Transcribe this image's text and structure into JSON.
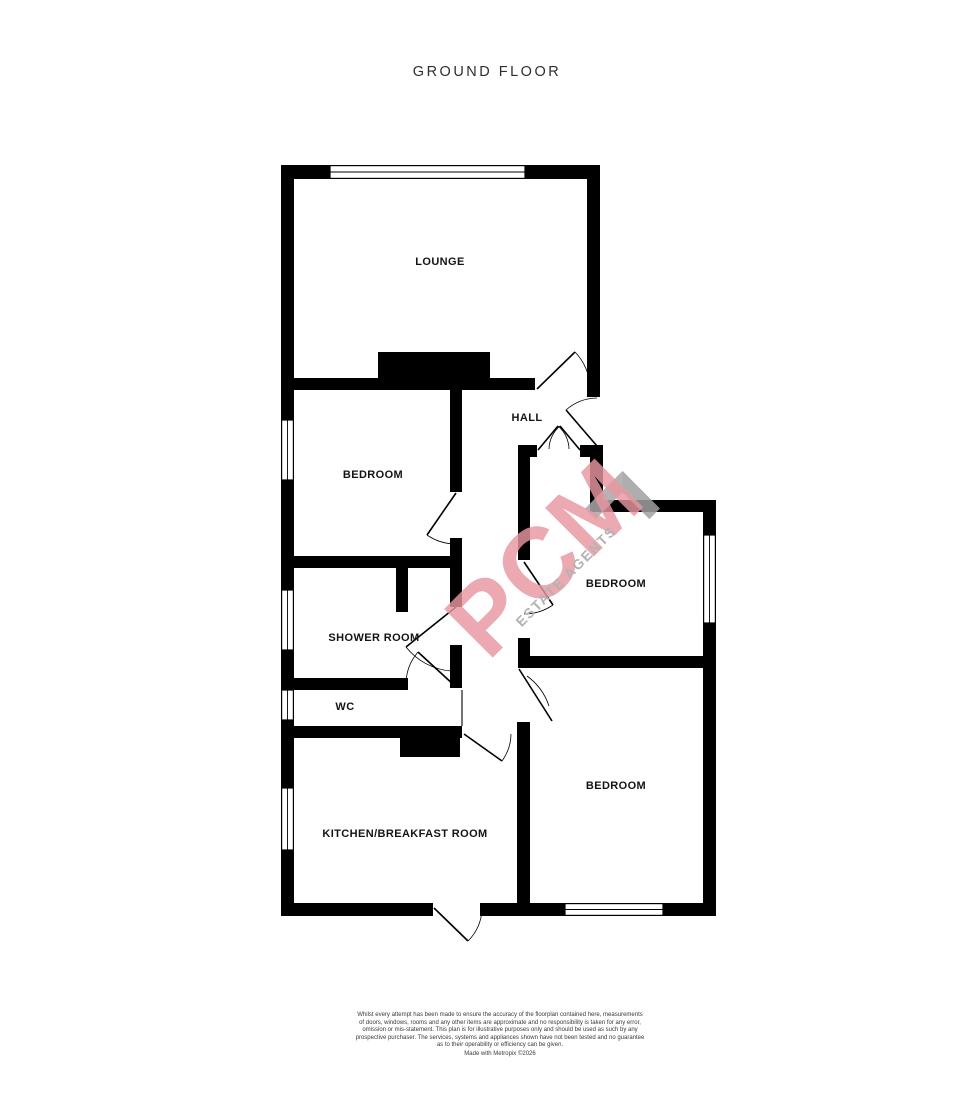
{
  "title": "GROUND FLOOR",
  "rooms": {
    "lounge": {
      "label": "LOUNGE"
    },
    "hall": {
      "label": "HALL"
    },
    "bedroom_left": {
      "label": "BEDROOM"
    },
    "shower_room": {
      "label": "SHOWER ROOM"
    },
    "wc": {
      "label": "WC"
    },
    "kitchen": {
      "label": "KITCHEN/BREAKFAST ROOM"
    },
    "bedroom_middle": {
      "label": "BEDROOM"
    },
    "bedroom_bottom": {
      "label": "BEDROOM"
    }
  },
  "watermark": {
    "brand": "PCM",
    "tagline": "ESTATE AGENTS",
    "brand_color": "#e897a1",
    "tagline_color": "#b3b3b3"
  },
  "colors": {
    "wall": "#000000",
    "background": "#ffffff"
  },
  "disclaimer": {
    "lines": [
      "Whilst every attempt has been made to ensure the accuracy of the floorplan contained here, measurements",
      "of doors, windows, rooms and any other items are approximate and no responsibility is taken for any error,",
      "omission or mis-statement. This plan is for illustrative purposes only and should be used as such by any",
      "prospective purchaser. The services, systems and appliances shown have not been tested and no guarantee",
      "as to their operability or efficiency can be given."
    ],
    "credit": "Made with Metropix ©2026"
  }
}
